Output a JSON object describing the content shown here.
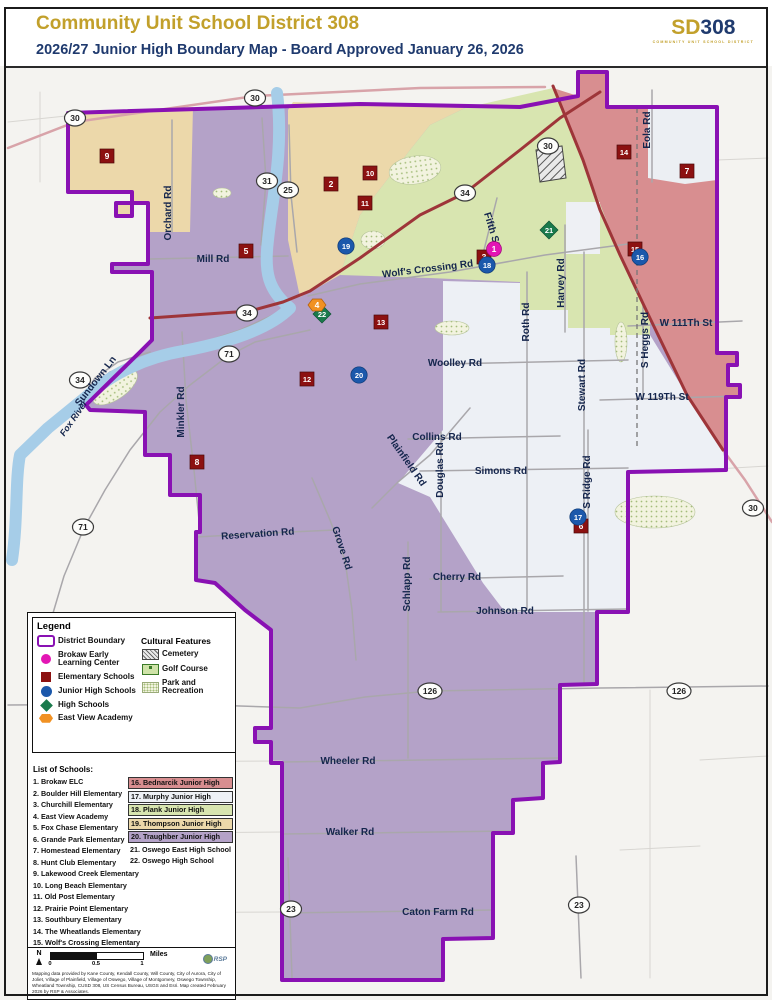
{
  "header": {
    "title": "Community Unit School District 308",
    "subtitle": "2026/27 Junior High Boundary Map - Board Approved January 26, 2026",
    "logo": {
      "prefix": "SD",
      "number": "308",
      "tagline": "COMMUNITY UNIT SCHOOL DISTRICT"
    }
  },
  "colors": {
    "boundary": "#8911b3",
    "thompson": "#ecd8aa",
    "plank": "#d8e5b0",
    "bednarcik": "#d88e90",
    "murphy": "#edf0f5",
    "traughber": "#b4a2c8",
    "outside": "#f4f3f0",
    "river": "#a6cde8",
    "road_major": "#9e3539",
    "road_pink": "#d8a3a9",
    "road_gray": "#a9a7ab",
    "road_faint": "#d8d6d2",
    "label": "#15264d",
    "elementary": "#8c1111",
    "junior_high": "#1b58ab",
    "brokaw": "#e316b4",
    "high_school": "#1a7a4c",
    "east_view": "#f19122"
  },
  "legend": {
    "title": "Legend",
    "items": [
      {
        "label": "District Boundary",
        "type": "boundary"
      },
      {
        "label": "Brokaw Early Learning Center",
        "type": "brokaw"
      },
      {
        "label": "Elementary Schools",
        "type": "elementary"
      },
      {
        "label": "Junior High Schools",
        "type": "junior_high"
      },
      {
        "label": "High Schools",
        "type": "high_school"
      },
      {
        "label": "East View Academy",
        "type": "east_view"
      }
    ],
    "cultural": {
      "title": "Cultural Features",
      "items": [
        {
          "label": "Cemetery",
          "type": "cemetery"
        },
        {
          "label": "Golf Course",
          "type": "golf"
        },
        {
          "label": "Park and Recreation",
          "type": "park"
        }
      ]
    }
  },
  "schools": {
    "title": "List of Schools:",
    "column1": [
      "1. Brokaw ELC",
      "2. Boulder Hill Elementary",
      "3. Churchill Elementary",
      "4. East View Academy",
      "5. Fox Chase Elementary",
      "6. Grande Park Elementary",
      "7. Homestead Elementary",
      "8. Hunt Club Elementary",
      "9. Lakewood Creek Elementary",
      "10. Long Beach Elementary",
      "11. Old Post Elementary",
      "12. Prairie Point Elementary",
      "13. Southbury Elementary",
      "14. The Wheatlands Elementary",
      "15. Wolf's Crossing Elementary"
    ],
    "column2": [
      {
        "label": "16. Bednarcik Junior High",
        "bg": "#d88e90"
      },
      {
        "label": "17. Murphy Junior High",
        "bg": "#eef1f6"
      },
      {
        "label": "18. Plank Junior High",
        "bg": "#d8e5b0"
      },
      {
        "label": "19. Thompson Junior High",
        "bg": "#ecd8aa"
      },
      {
        "label": "20. Traughber Junior High",
        "bg": "#b4a2c8"
      },
      {
        "label": "21. Oswego East High School",
        "bg": ""
      },
      {
        "label": "22. Oswego High School",
        "bg": ""
      }
    ]
  },
  "scalebar": {
    "north": "N",
    "ticks": [
      "0",
      "0.5",
      "1"
    ],
    "unit": "Miles"
  },
  "attribution": "Mapping data provided by Kane County, Kendall County, Will County, City of Aurora, City of Joliet, Village of Plainfield, Village of Oswego, Village of Montgomery, Oswego Township, Wheatland Township, CUSD 308, US Census Bureau, USGS and Esri.  Map created February 2026 by RSP & Associates.",
  "rsp_logo": "RSP",
  "map": {
    "district_points": "68,113 360,104 520,107 578,96 578,72 607,72 607,107 717,107 717,353 737,353 737,365 728,365 728,385 740,385 740,397 726,397 726,470 628,472 628,612 597,612 597,684 560,685 560,762 543,763 543,798 513,800 513,833 493,833 493,938 443,939 443,980 282,980 282,763 271,763 271,742 255,742 255,728 271,728 271,630 245,610 215,583 196,580 196,532 200,532 200,495 170,495 170,455 145,455 145,412 90,410 86,405 140,352 152,340 152,272 112,272 112,264 148,264 148,203 116,203 116,216 132,216 132,192 68,192",
    "regions": [
      {
        "name": "region-thompson-west",
        "color": "thompson",
        "points": "68,113 193,107 190,232 148,232 148,203 116,203 116,216 132,216 132,192 68,192"
      },
      {
        "name": "region-thompson-east",
        "color": "thompson",
        "points": "293,102 465,108 430,125 410,150 360,215 340,275 310,292 300,297 288,240 288,110"
      },
      {
        "name": "region-plank",
        "color": "plank",
        "points": "465,108 553,88 583,160 620,255 650,320 650,335 610,335 610,328 568,328 568,310 520,310 520,282 430,278 340,275 360,215 410,150 430,125"
      },
      {
        "name": "region-bednarcik",
        "color": "bednarcik",
        "points": "553,88 578,96 578,72 607,72 607,107 717,107 717,353 737,353 737,365 728,365 728,385 740,385 740,397 726,397 726,452 687,395 647,312 620,255 583,160"
      },
      {
        "name": "region-murphy",
        "color": "murphy",
        "points": "443,281 520,283 520,310 568,310 568,328 610,328 610,335 650,335 687,395 723,450 726,470 628,472 628,612 505,612 483,583 430,497 398,483 443,430"
      }
    ],
    "patches": [
      {
        "name": "patch-aurora-grid",
        "type": "poly",
        "points": "648,107 717,107 717,180 685,184 648,178",
        "fill": "#eceff3"
      },
      {
        "name": "patch-subdivision",
        "type": "rect",
        "x": 566,
        "y": 202,
        "w": 34,
        "h": 52,
        "fill": "#eef0f4"
      }
    ],
    "green_areas": [
      {
        "name": "golf-course",
        "cx": 415,
        "cy": 170,
        "rx": 26,
        "ry": 14,
        "rot": -8
      },
      {
        "name": "golf-course",
        "cx": 373,
        "cy": 240,
        "rx": 12,
        "ry": 9,
        "rot": 0
      },
      {
        "name": "golf-course",
        "cx": 222,
        "cy": 193,
        "rx": 9,
        "ry": 5,
        "rot": 0
      },
      {
        "name": "park",
        "cx": 115,
        "cy": 387,
        "rx": 26,
        "ry": 12,
        "rot": -35
      },
      {
        "name": "park",
        "cx": 452,
        "cy": 328,
        "rx": 17,
        "ry": 7,
        "rot": 0
      },
      {
        "name": "park",
        "cx": 655,
        "cy": 512,
        "rx": 40,
        "ry": 16,
        "rot": 0
      },
      {
        "name": "park",
        "cx": 621,
        "cy": 342,
        "rx": 6,
        "ry": 20,
        "rot": 0
      }
    ],
    "cemetery": {
      "points": "536,150 562,146 566,178 540,182"
    },
    "river": {
      "name": "fox-river",
      "path": "M 277,93 C 284,150 272,200 268,240 C 264,272 268,290 290,308 C 268,330 225,343 183,351 C 148,357 113,372 86,397 L 48,428 L 20,455 C 15,480 18,520 12,560"
    },
    "roads": [
      {
        "name": "orchard-rd",
        "cls": "gray",
        "pts": "172,120 172,232"
      },
      {
        "name": "mill-rd",
        "cls": "gray",
        "pts": "150,259 288,256"
      },
      {
        "name": "route-31-rd",
        "cls": "gray",
        "pts": "262,118 266,180 261,245"
      },
      {
        "name": "route-25-rd",
        "cls": "gray",
        "pts": "289,125 291,195 297,252"
      },
      {
        "name": "wolfs-crossing-rd",
        "cls": "gray",
        "pts": "308,296 360,284 450,272 545,255 628,244"
      },
      {
        "name": "fifth-st",
        "cls": "gray",
        "pts": "497,198 481,262"
      },
      {
        "name": "harvey-rd",
        "cls": "gray",
        "pts": "565,225 565,332"
      },
      {
        "name": "roth-rd",
        "cls": "gray",
        "pts": "527,272 527,610"
      },
      {
        "name": "stewart-rd",
        "cls": "gray",
        "pts": "584,252 584,683"
      },
      {
        "name": "s-heggs-rd",
        "cls": "gray",
        "pts": "643,305 643,398"
      },
      {
        "name": "eola-rd",
        "cls": "gray",
        "pts": "652,90 652,182"
      },
      {
        "name": "w-111th-st",
        "cls": "gray",
        "pts": "628,326 742,321"
      },
      {
        "name": "w-119th-st",
        "cls": "gray",
        "pts": "600,400 740,396"
      },
      {
        "name": "woolley-rd",
        "cls": "gray",
        "pts": "443,364 628,360"
      },
      {
        "name": "collins-rd",
        "cls": "gray",
        "pts": "408,439 560,436"
      },
      {
        "name": "plainfield-rd",
        "cls": "gray",
        "pts": "470,408 430,455 398,482 372,508"
      },
      {
        "name": "douglas-rd",
        "cls": "gray",
        "pts": "441,432 441,611"
      },
      {
        "name": "simons-rd",
        "cls": "gray",
        "pts": "420,471 628,468"
      },
      {
        "name": "s-ridge-rd",
        "cls": "gray",
        "pts": "588,430 588,611"
      },
      {
        "name": "minkler-rd",
        "cls": "gray",
        "pts": "182,332 186,400 194,470 199,520"
      },
      {
        "name": "route-34-sw-rd",
        "cls": "gray",
        "pts": "288,308 240,330 195,345 150,358 110,372 85,392 55,420 28,452"
      },
      {
        "name": "route-71-rd",
        "cls": "gray",
        "pts": "310,330 255,342 228,356 190,385 160,412 130,450 105,490 84,528 64,576 48,630"
      },
      {
        "name": "reservation-rd",
        "cls": "gray",
        "pts": "196,537 268,533 335,530"
      },
      {
        "name": "grove-rd",
        "cls": "gray",
        "pts": "312,478 330,520 345,560 352,610 356,660"
      },
      {
        "name": "schlapp-rd",
        "cls": "gray",
        "pts": "408,542 408,758"
      },
      {
        "name": "cherry-rd",
        "cls": "gray",
        "pts": "430,579 563,576"
      },
      {
        "name": "johnson-rd",
        "cls": "gray",
        "pts": "438,612 628,609"
      },
      {
        "name": "route-126-rd",
        "cls": "gray",
        "pts": "8,705 180,704 300,708 365,697 430,691 600,688 768,686"
      },
      {
        "name": "wheeler-rd",
        "cls": "gray",
        "pts": "282,762 560,758"
      },
      {
        "name": "walker-rd",
        "cls": "gray",
        "pts": "282,834 513,831"
      },
      {
        "name": "caton-farm-rd",
        "cls": "gray",
        "pts": "282,913 493,910"
      },
      {
        "name": "route-23-w-rd",
        "cls": "gray",
        "pts": "288,858 292,978"
      },
      {
        "name": "route-23-e-rd",
        "cls": "gray",
        "pts": "576,856 581,978"
      },
      {
        "name": "sundown-ln",
        "cls": "gray",
        "pts": "150,352 118,362 95,378 82,398"
      },
      {
        "name": "outside-rd",
        "cls": "faint",
        "pts": "8,122 66,116"
      },
      {
        "name": "outside-rd",
        "cls": "faint",
        "pts": "40,92 40,182"
      },
      {
        "name": "outside-rd",
        "cls": "faint",
        "pts": "717,160 768,158"
      },
      {
        "name": "outside-rd",
        "cls": "faint",
        "pts": "650,690 650,978"
      },
      {
        "name": "outside-rd",
        "cls": "faint",
        "pts": "700,470 768,466"
      },
      {
        "name": "outside-rd",
        "cls": "faint",
        "pts": "60,762 282,761"
      },
      {
        "name": "outside-rd",
        "cls": "faint",
        "pts": "60,834 282,832"
      },
      {
        "name": "outside-rd",
        "cls": "faint",
        "pts": "60,913 282,912"
      },
      {
        "name": "outside-rd",
        "cls": "faint",
        "pts": "620,850 700,846"
      },
      {
        "name": "outside-rd",
        "cls": "faint",
        "pts": "700,760 768,756"
      },
      {
        "name": "route-30-nw-rd",
        "cls": "pink",
        "pts": "8,148 75,122 255,96 420,88 545,87"
      },
      {
        "name": "route-30-se-rd",
        "cls": "pink",
        "pts": "723,450 745,480 772,522"
      },
      {
        "name": "route-34-rd",
        "cls": "major",
        "pts": "150,318 250,311 283,302 310,291 360,258 420,215 465,193 520,150 560,118 600,92"
      },
      {
        "name": "route-30-ne-rd",
        "cls": "major",
        "pts": "553,86 583,160 600,210 620,255 647,312 687,395 723,450"
      }
    ],
    "railroad": {
      "name": "railroad",
      "pts": "637,108 637,450"
    },
    "shields": [
      {
        "num": "30",
        "x": 75,
        "y": 118
      },
      {
        "num": "30",
        "x": 255,
        "y": 98
      },
      {
        "num": "31",
        "x": 267,
        "y": 181
      },
      {
        "num": "25",
        "x": 288,
        "y": 190
      },
      {
        "num": "34",
        "x": 465,
        "y": 193
      },
      {
        "num": "30",
        "x": 548,
        "y": 146
      },
      {
        "num": "34",
        "x": 247,
        "y": 313
      },
      {
        "num": "34",
        "x": 80,
        "y": 380
      },
      {
        "num": "71",
        "x": 229,
        "y": 354
      },
      {
        "num": "71",
        "x": 83,
        "y": 527
      },
      {
        "num": "30",
        "x": 753,
        "y": 508
      },
      {
        "num": "126",
        "x": 430,
        "y": 691
      },
      {
        "num": "126",
        "x": 679,
        "y": 691
      },
      {
        "num": "23",
        "x": 291,
        "y": 909
      },
      {
        "num": "23",
        "x": 579,
        "y": 905
      }
    ],
    "labels": [
      {
        "t": "Orchard Rd",
        "x": 171,
        "y": 213,
        "r": -90
      },
      {
        "t": "Mill Rd",
        "x": 213,
        "y": 262,
        "r": 0
      },
      {
        "t": "Fifth St",
        "x": 489,
        "y": 230,
        "r": 73
      },
      {
        "t": "Wolf's Crossing Rd",
        "x": 428,
        "y": 272,
        "r": -7
      },
      {
        "t": "Eola Rd",
        "x": 650,
        "y": 130,
        "r": -90
      },
      {
        "t": "Harvey Rd",
        "x": 564,
        "y": 283,
        "r": -90
      },
      {
        "t": "Roth Rd",
        "x": 529,
        "y": 322,
        "r": -90
      },
      {
        "t": "W 111Th St",
        "x": 686,
        "y": 326,
        "r": 0
      },
      {
        "t": "W 119Th St",
        "x": 662,
        "y": 400,
        "r": 0
      },
      {
        "t": "S Heggs Rd",
        "x": 648,
        "y": 340,
        "r": -90
      },
      {
        "t": "Stewart Rd",
        "x": 585,
        "y": 385,
        "r": -90
      },
      {
        "t": "Woolley Rd",
        "x": 455,
        "y": 366,
        "r": 0
      },
      {
        "t": "Collins Rd",
        "x": 437,
        "y": 440,
        "r": 0
      },
      {
        "t": "Plainfield Rd",
        "x": 404,
        "y": 462,
        "r": 55
      },
      {
        "t": "Douglas Rd",
        "x": 443,
        "y": 470,
        "r": -90
      },
      {
        "t": "Simons Rd",
        "x": 501,
        "y": 474,
        "r": 0
      },
      {
        "t": "S Ridge Rd",
        "x": 590,
        "y": 482,
        "r": -90
      },
      {
        "t": "Minkler Rd",
        "x": 184,
        "y": 412,
        "r": -90
      },
      {
        "t": "Sundown Ln",
        "x": 98,
        "y": 383,
        "r": -52
      },
      {
        "t": "Fox River",
        "x": 76,
        "y": 420,
        "r": -55,
        "river": true
      },
      {
        "t": "Reservation Rd",
        "x": 258,
        "y": 537,
        "r": -4
      },
      {
        "t": "Grove Rd",
        "x": 339,
        "y": 549,
        "r": 72
      },
      {
        "t": "Schlapp Rd",
        "x": 410,
        "y": 584,
        "r": -90
      },
      {
        "t": "Cherry Rd",
        "x": 457,
        "y": 580,
        "r": 0
      },
      {
        "t": "Johnson Rd",
        "x": 505,
        "y": 614,
        "r": 0
      },
      {
        "t": "Wheeler Rd",
        "x": 348,
        "y": 764,
        "r": 0
      },
      {
        "t": "Walker Rd",
        "x": 350,
        "y": 835,
        "r": 0
      },
      {
        "t": "Caton Farm Rd",
        "x": 438,
        "y": 915,
        "r": 0
      }
    ],
    "markers": [
      {
        "num": "9",
        "type": "elementary",
        "x": 107,
        "y": 156
      },
      {
        "num": "2",
        "type": "elementary",
        "x": 331,
        "y": 184
      },
      {
        "num": "10",
        "type": "elementary",
        "x": 370,
        "y": 173
      },
      {
        "num": "11",
        "type": "elementary",
        "x": 365,
        "y": 203
      },
      {
        "num": "5",
        "type": "elementary",
        "x": 246,
        "y": 251
      },
      {
        "num": "3",
        "type": "elementary",
        "x": 484,
        "y": 257
      },
      {
        "num": "14",
        "type": "elementary",
        "x": 624,
        "y": 152
      },
      {
        "num": "7",
        "type": "elementary",
        "x": 687,
        "y": 171
      },
      {
        "num": "15",
        "type": "elementary",
        "x": 635,
        "y": 249
      },
      {
        "num": "13",
        "type": "elementary",
        "x": 381,
        "y": 322
      },
      {
        "num": "12",
        "type": "elementary",
        "x": 307,
        "y": 379
      },
      {
        "num": "8",
        "type": "elementary",
        "x": 197,
        "y": 462
      },
      {
        "num": "6",
        "type": "elementary",
        "x": 581,
        "y": 526
      },
      {
        "num": "19",
        "type": "junior_high",
        "x": 346,
        "y": 246
      },
      {
        "num": "18",
        "type": "junior_high",
        "x": 487,
        "y": 265
      },
      {
        "num": "16",
        "type": "junior_high",
        "x": 640,
        "y": 257
      },
      {
        "num": "20",
        "type": "junior_high",
        "x": 359,
        "y": 375
      },
      {
        "num": "17",
        "type": "junior_high",
        "x": 578,
        "y": 517
      },
      {
        "num": "1",
        "type": "brokaw",
        "x": 494,
        "y": 249
      },
      {
        "num": "21",
        "type": "high_school",
        "x": 549,
        "y": 230
      },
      {
        "num": "22",
        "type": "high_school",
        "x": 322,
        "y": 314
      },
      {
        "num": "4",
        "type": "east_view",
        "x": 317,
        "y": 305
      }
    ]
  }
}
